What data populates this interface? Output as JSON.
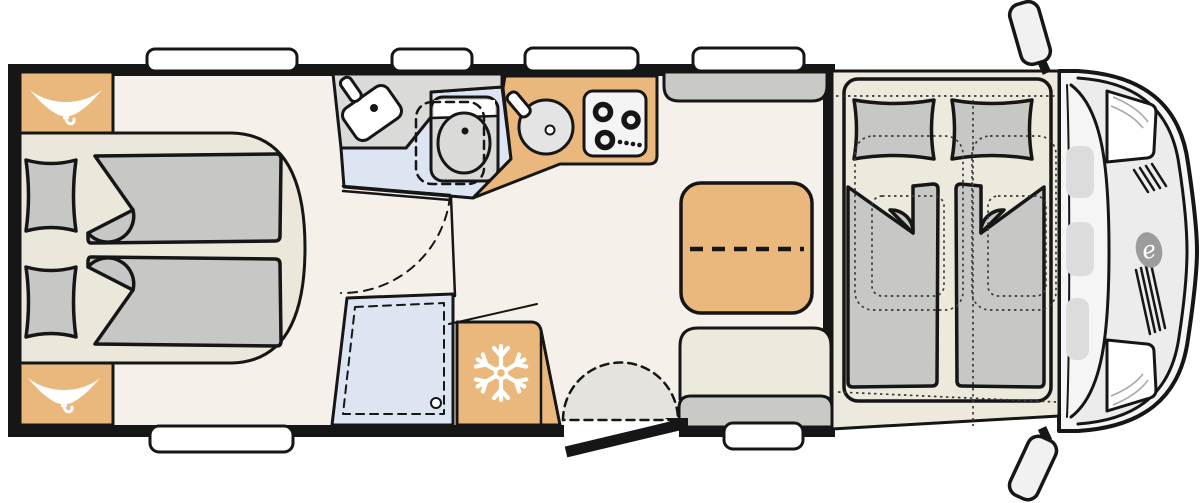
{
  "title": "Motorhome floor plan (top view)",
  "colors": {
    "outline": "#161616",
    "floor": "#f5f1ea",
    "platform": "#ebe7db",
    "cream": "#ede9dd",
    "furniture_orange": "#eab87d",
    "mattress_gray": "#c7c8c5",
    "bench_gray": "#c9c9c6",
    "bath_gray": "#dadad9",
    "water_blue": "#dce5f1",
    "swing_gray": "#e4e3de",
    "white": "#ffffff",
    "cab_body": "#f5f5f5",
    "hood_gray": "#ececec",
    "dash_blob": "#dcdcdc",
    "logo_gray": "#9c9c9c",
    "detail": "#a8a8a8"
  },
  "cab": {
    "logo_glyph": "e"
  },
  "icons": [
    "hanger-icon",
    "snowflake-icon",
    "faucet-icon",
    "burner-icon",
    "shower-drain-icon",
    "mirror-icon",
    "headlight-icon",
    "grille-icon"
  ],
  "features": [
    "rear-twin-beds",
    "wardrobe-top",
    "wardrobe-bottom",
    "washroom-basin",
    "swivel-toilet",
    "shower-tray",
    "fridge",
    "kitchen-sink",
    "gas-hob",
    "half-dinette-table",
    "dinette-benches",
    "entry-door",
    "entry-step",
    "drop-down-bed",
    "swivel-cab-seats",
    "driver-cab",
    "side-mirrors",
    "roof-windows"
  ]
}
